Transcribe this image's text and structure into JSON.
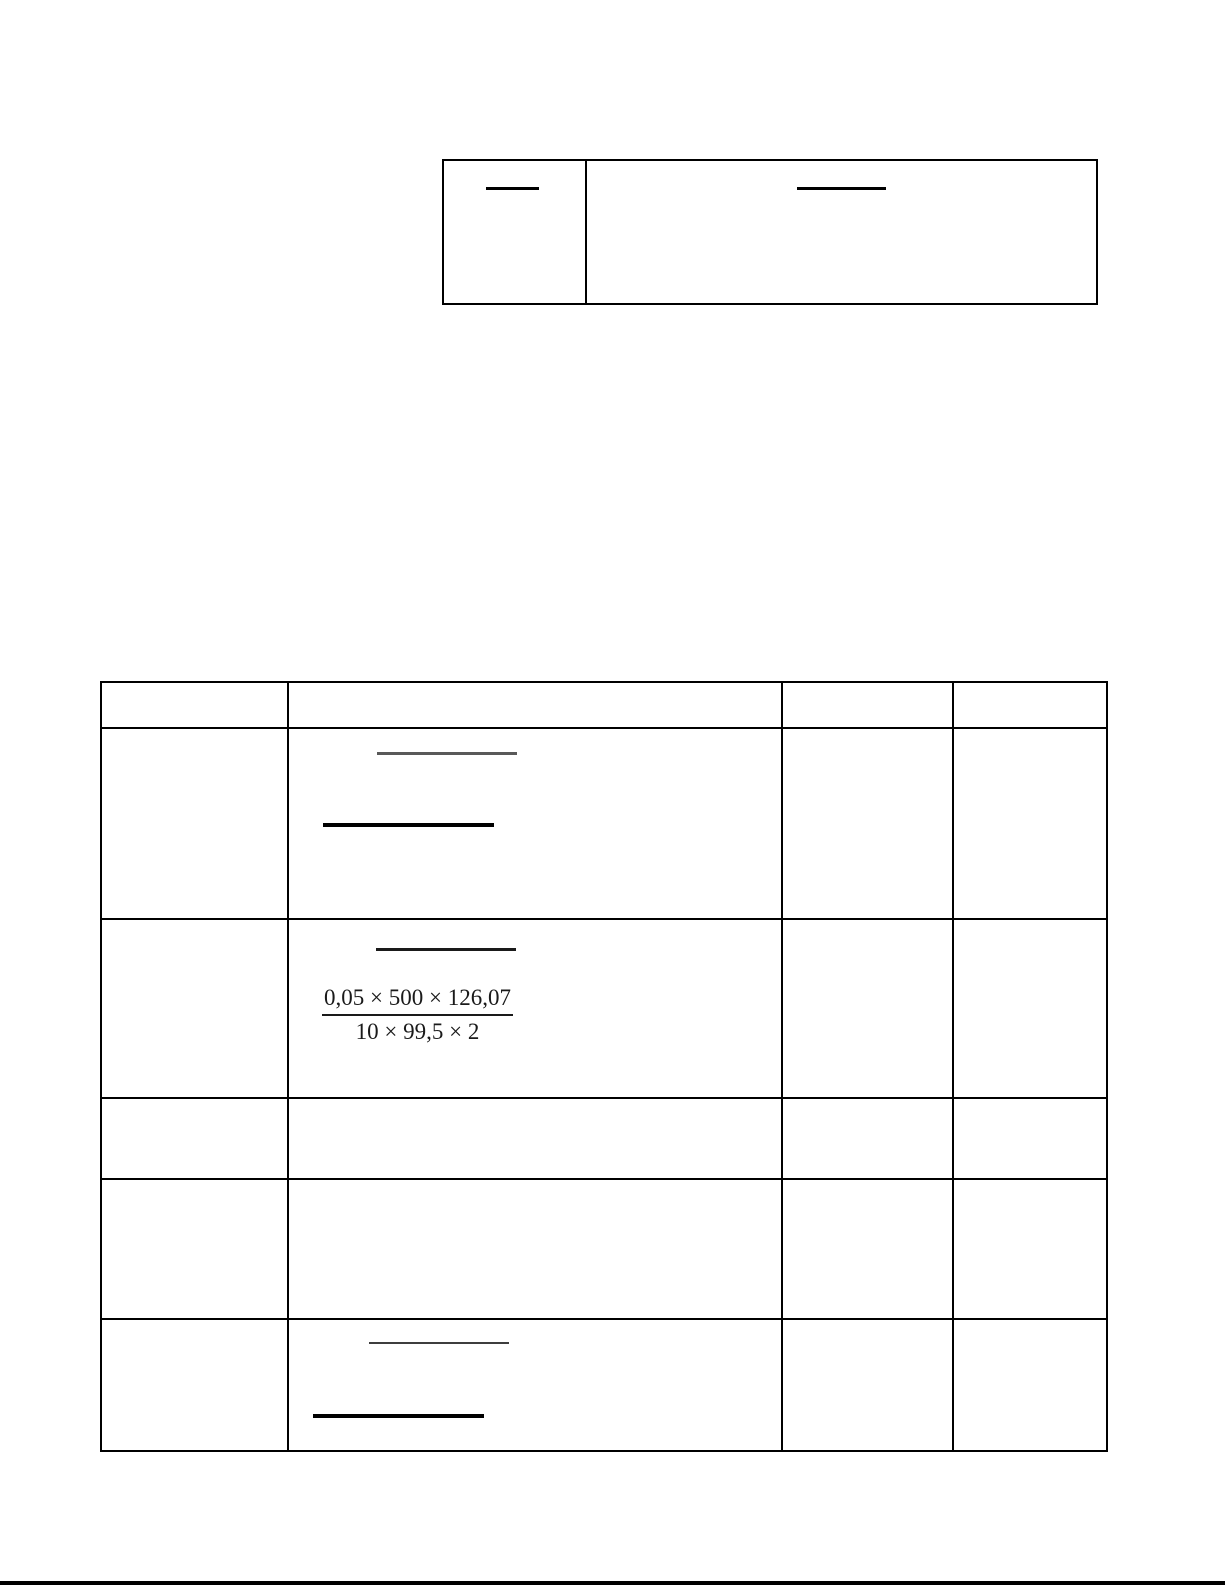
{
  "page": {
    "background": "#ffffff",
    "bottom_bar_color": "#000000"
  },
  "colors": {
    "table_border": "#000000",
    "black_fraction_bar": "#000000",
    "gray_fraction_bar": "#595959",
    "thin_fraction_bar": "#3d3d3d"
  },
  "top_table": {
    "columns": 2,
    "cells": [
      {
        "text": "",
        "content": "fraction-bar"
      },
      {
        "text": "",
        "content": "fraction-bar"
      }
    ]
  },
  "main_table": {
    "columns": 4,
    "header": {
      "col1": "",
      "col2": "",
      "col3": "",
      "col4": ""
    },
    "rows": [
      {
        "col1": "",
        "col3": "",
        "col4": "",
        "col2_content": [
          "gray-fraction-bar",
          "black-fraction-bar"
        ]
      },
      {
        "col1": "",
        "col3": "",
        "col4": "",
        "col2_content": [
          "black-fraction-bar",
          "fraction-expression"
        ],
        "fraction": {
          "numerator": "0,05 × 500 × 126,07",
          "denominator": "10 × 99,5 × 2"
        }
      },
      {
        "col1": "",
        "col2": "",
        "col3": "",
        "col4": ""
      },
      {
        "col1": "",
        "col2": "",
        "col3": "",
        "col4": ""
      },
      {
        "col1": "",
        "col3": "",
        "col4": "",
        "col2_content": [
          "thin-fraction-bar",
          "black-fraction-bar"
        ]
      }
    ]
  }
}
